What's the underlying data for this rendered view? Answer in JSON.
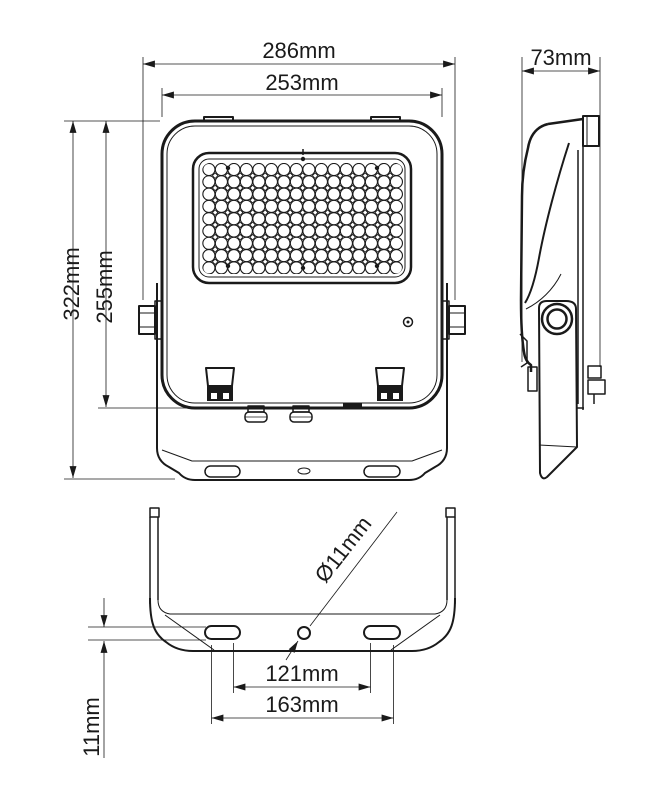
{
  "drawing": {
    "subject": "LED floodlight",
    "views": {
      "front": {
        "dims": {
          "overall_width": "286mm",
          "body_width": "253mm",
          "overall_height": "322mm",
          "body_height": "255mm"
        },
        "led_grid": {
          "cols": 16,
          "rows": 9
        }
      },
      "side": {
        "dims": {
          "depth": "73mm"
        }
      },
      "bottom": {
        "dims": {
          "mount_hole_diameter": "Ø11mm",
          "slot_span_inner": "121mm",
          "slot_span_outer": "163mm",
          "plate_thickness": "11mm"
        }
      }
    },
    "colors": {
      "line": "#1a1a1a",
      "background": "#ffffff"
    }
  }
}
